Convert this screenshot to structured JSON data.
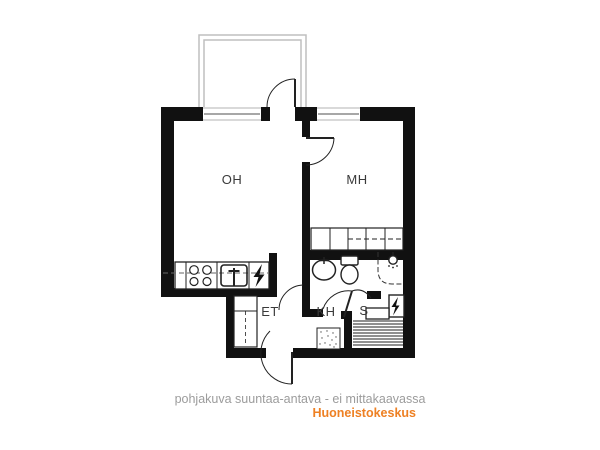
{
  "floor_plan": {
    "rooms": [
      {
        "label": "OH"
      },
      {
        "label": "MH"
      },
      {
        "label": "ET"
      },
      {
        "label": "KH"
      },
      {
        "label": "S"
      }
    ],
    "footer": {
      "disclaimer": "pohjakuva suuntaa-antava - ei mittakaavassa",
      "brand": "Huoneistokeskus"
    },
    "colors": {
      "wall": "#111111",
      "line": "#222222",
      "balcony_line": "#bfbfbf",
      "disclaimer_text": "#9c9c9c",
      "brand_text": "#ee8023",
      "background": "#ffffff"
    },
    "icons": {
      "electrical_panel": "lightning-bolt",
      "sauna_heater": "lightning-bolt",
      "shower": "shower-head",
      "stove": "four-burners",
      "kitchen_sink": "sink-basin",
      "bathroom_sink": "oval-basin",
      "toilet": "toilet-bowl",
      "floor_drain": "stippled-square"
    }
  }
}
